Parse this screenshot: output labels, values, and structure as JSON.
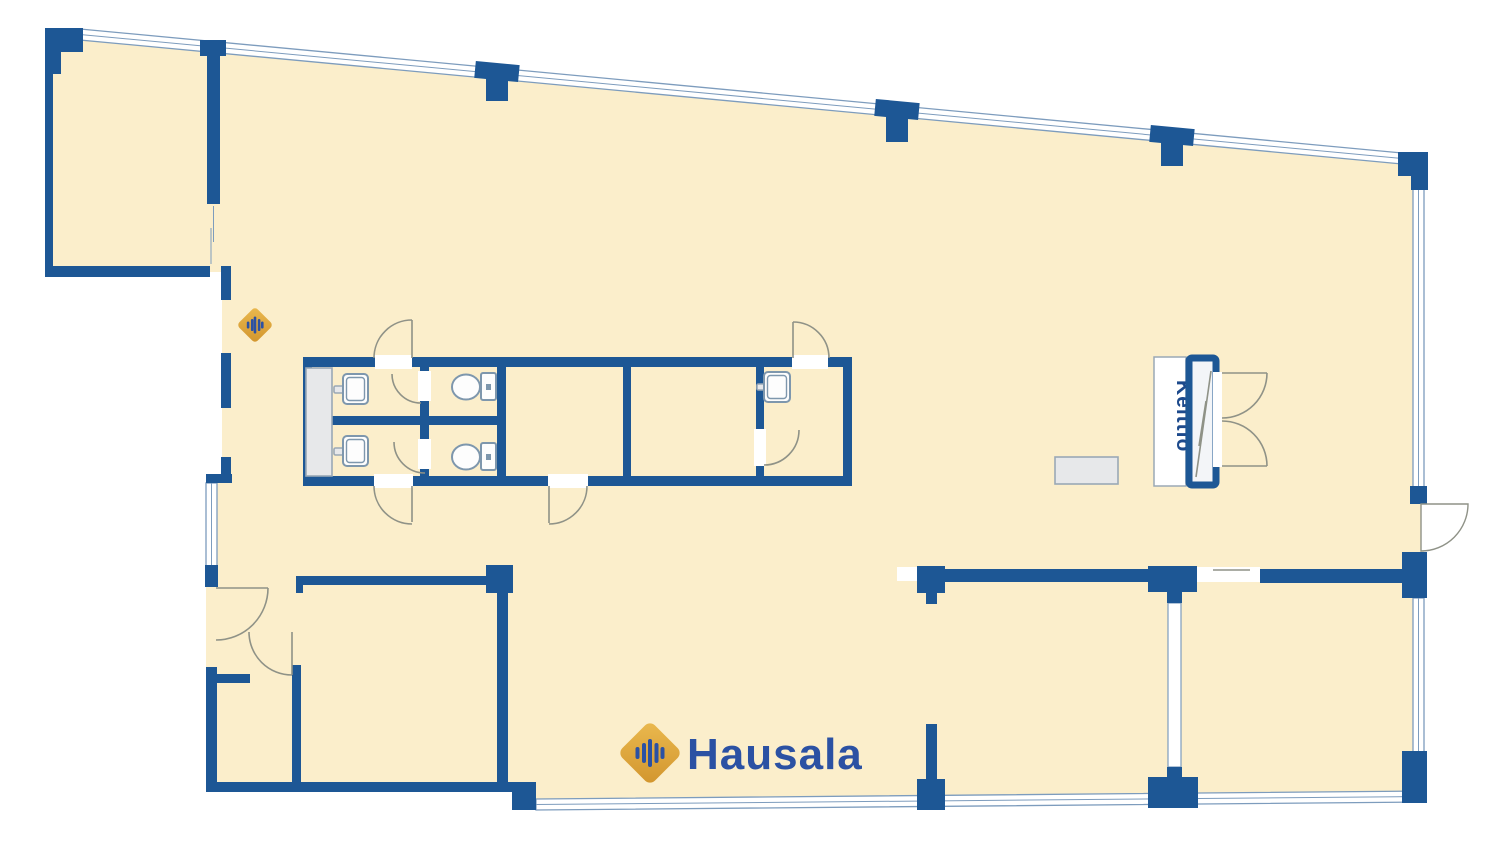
{
  "plan": {
    "kitchen_label": "Keittiö"
  },
  "brand": {
    "name": "Hausala"
  },
  "colors": {
    "floor": "#fbeecb",
    "wall": "#1d5795",
    "band-line": "#7d9cbd",
    "door": "#8f9287",
    "fixture": "#7e97ad",
    "gray-fill": "#e7e8ea",
    "gray-stroke": "#9aa8b6",
    "gold": "#dfa93e",
    "gold-dark": "#d2952d",
    "gold-light": "#eab94f",
    "navy-text": "#2b51a3",
    "label-text": "#1d4a8c"
  }
}
